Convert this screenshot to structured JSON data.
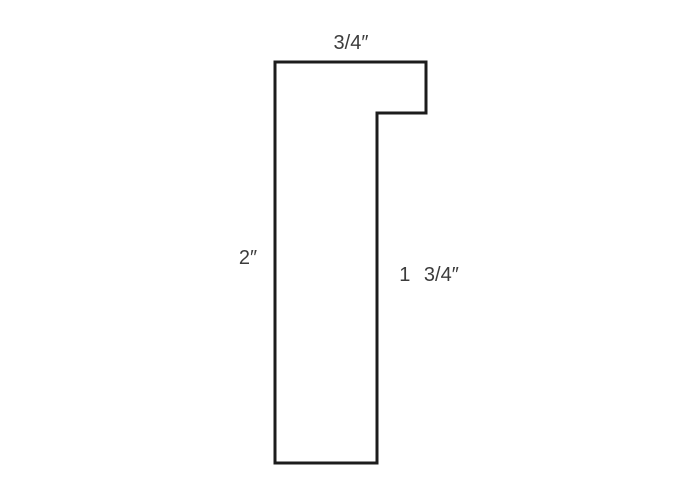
{
  "diagram": {
    "background_color": "#ffffff",
    "outline_color": "#1c1c1c",
    "text_color": "#3c3c3c",
    "shape": {
      "name": "stepped-profile-outline",
      "points": "275,62 426,62 426,113 377,113 377,463 275,463"
    },
    "labels": {
      "top_width": "3/4″",
      "left_height": "2″",
      "right_height": "1 3/4″"
    }
  }
}
